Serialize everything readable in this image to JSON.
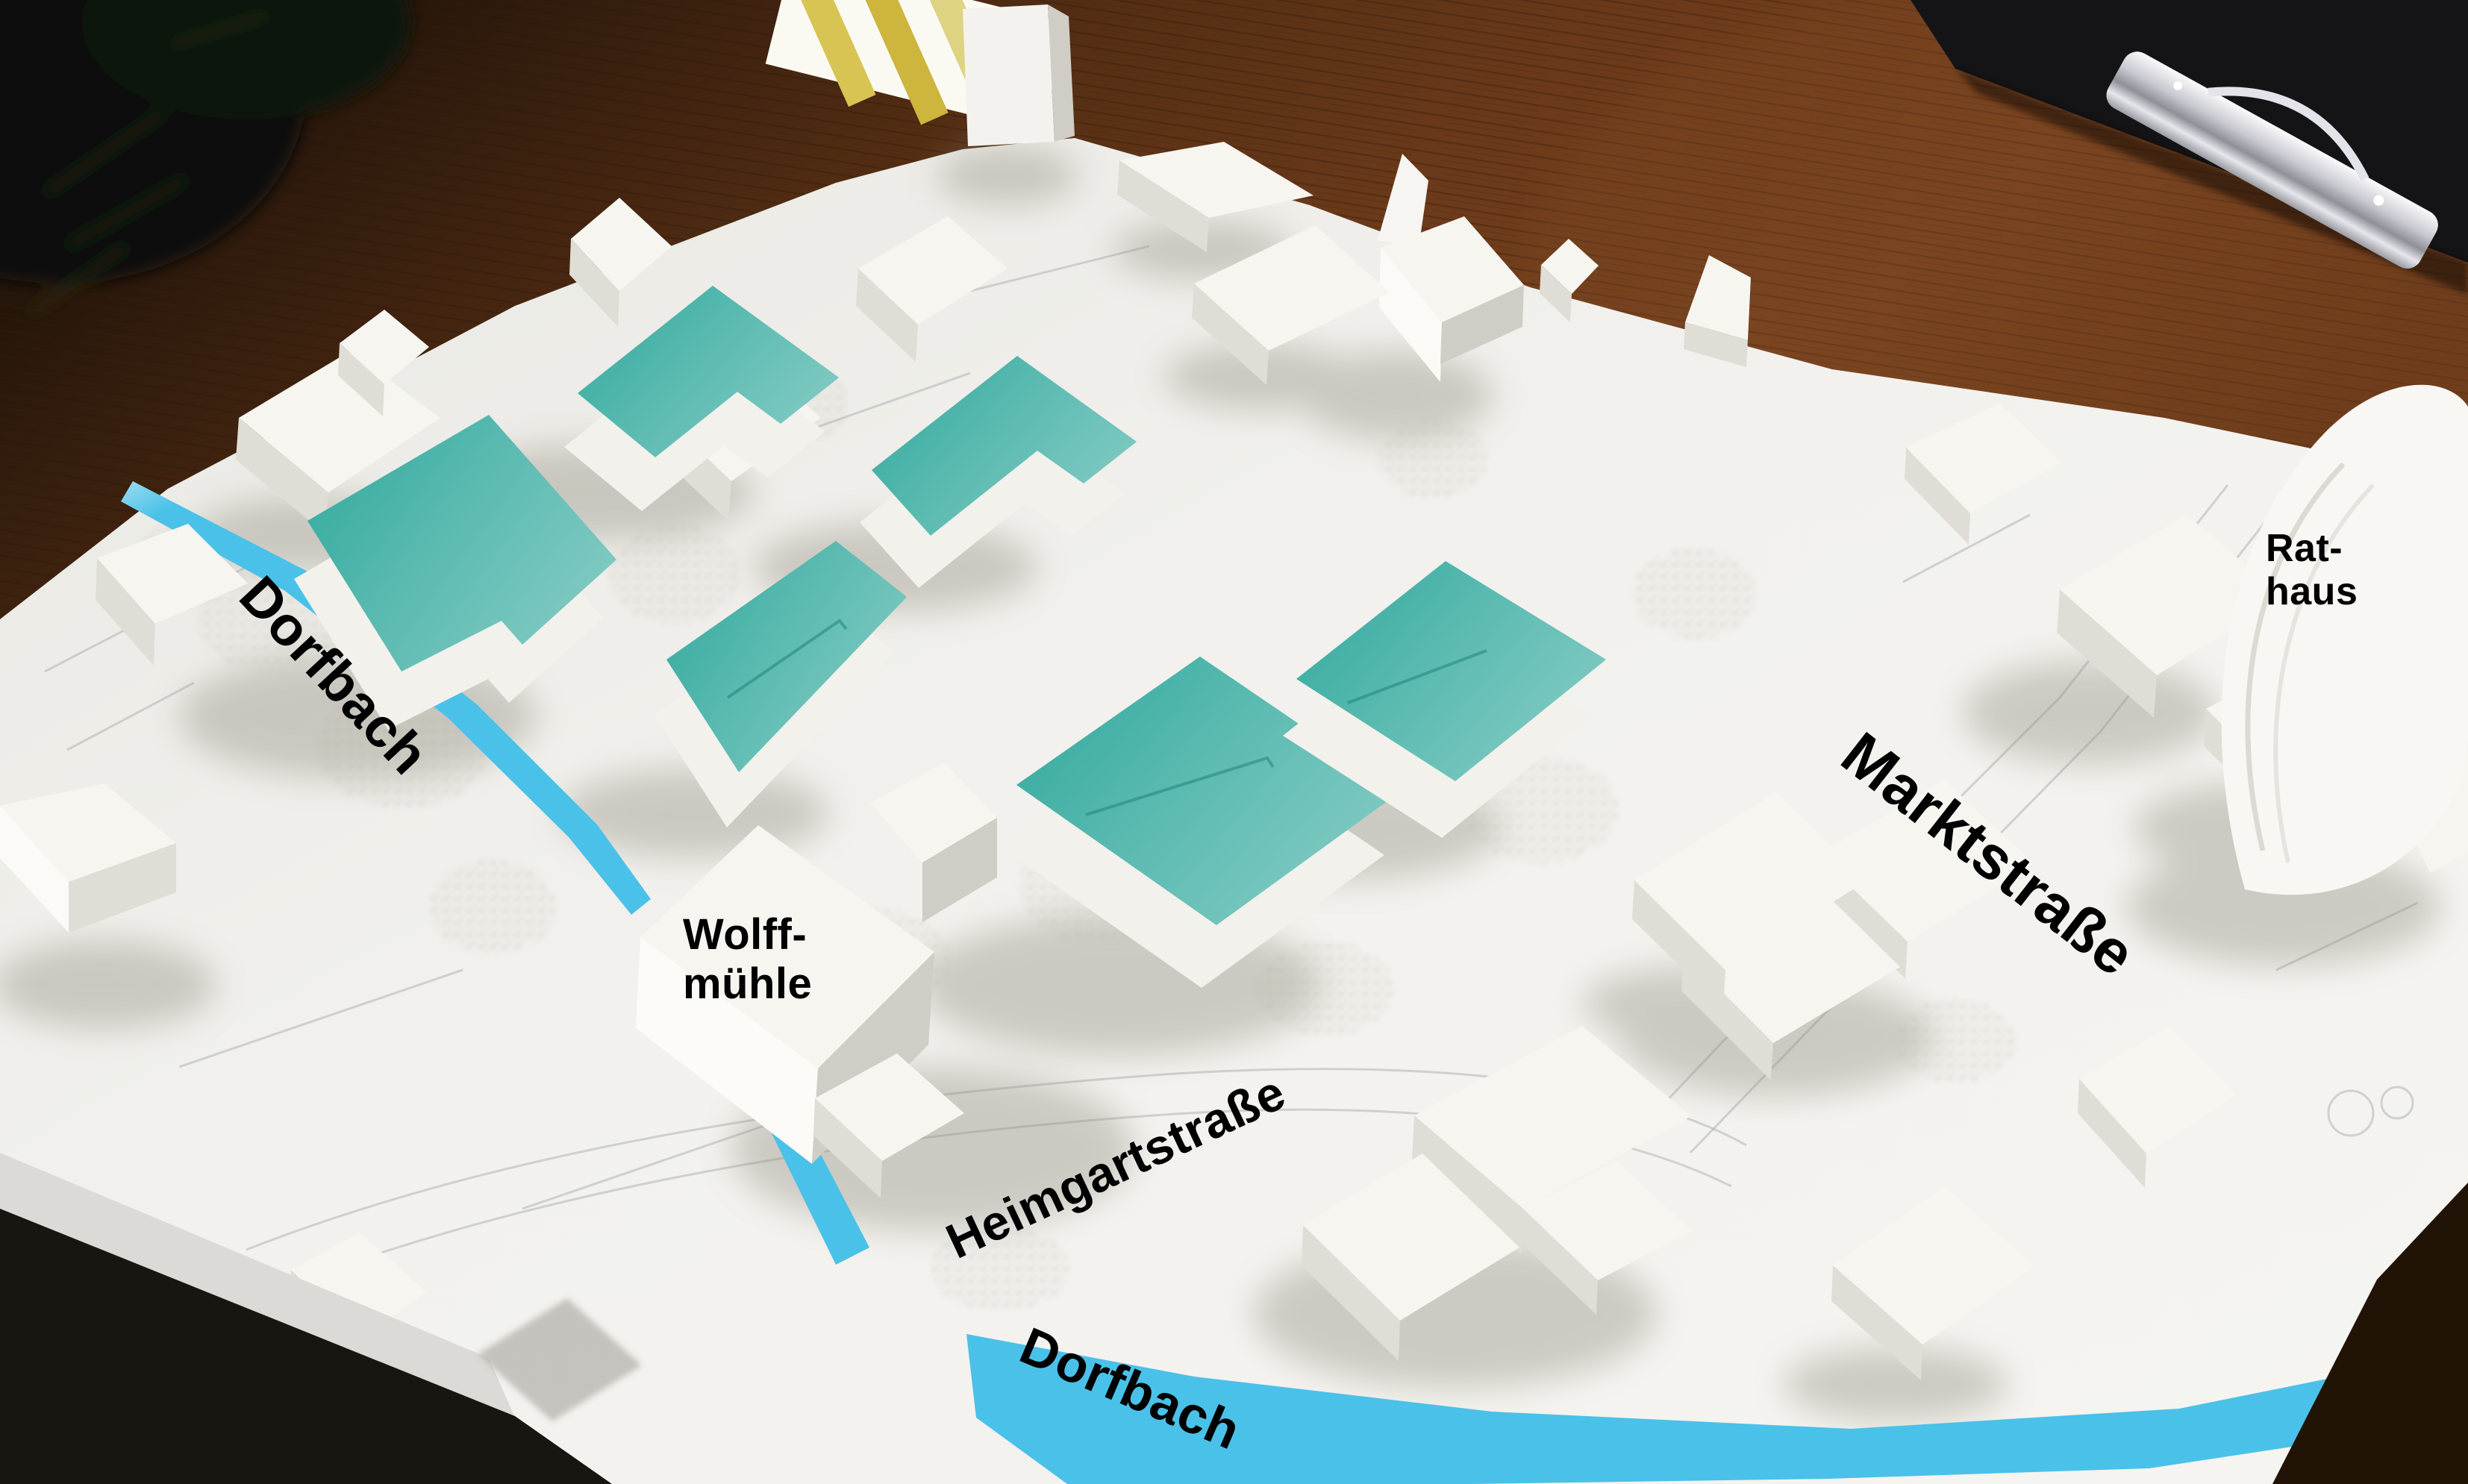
{
  "labels": {
    "dorfbach_upper": "Dorfbach",
    "wolffmuehle_line1": "Wolff-",
    "wolffmuehle_line2": "mühle",
    "heimgartstrasse": "Heimgartstraße",
    "marktstrasse": "Marktstraße",
    "rathaus_line1": "Rat-",
    "rathaus_line2": "haus",
    "dorfbach_lower": "Dorfbach"
  },
  "colors": {
    "highlight_teal": "#2fa89c",
    "stream_blue": "#4ac1e8",
    "model_white": "#f0efeb",
    "table_wood_brown": "#63351a",
    "label_text": "#000000"
  }
}
